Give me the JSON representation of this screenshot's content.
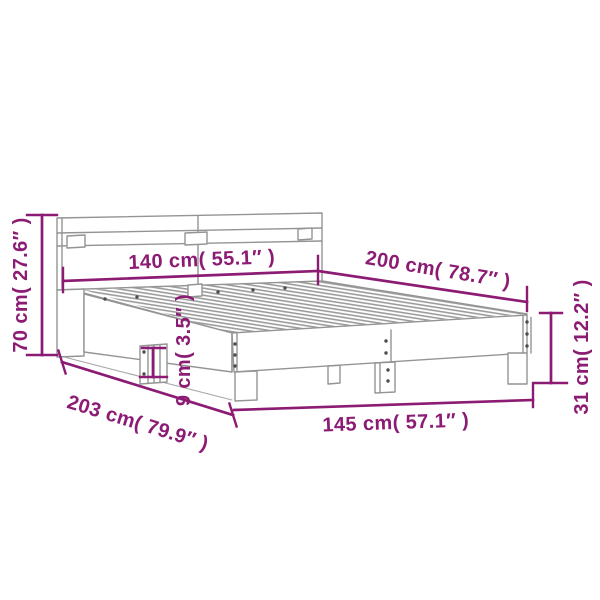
{
  "colors": {
    "accent": "#8c1b74",
    "line": "#949494",
    "line-light": "#9c9c9c",
    "dot": "#4d4d4d",
    "bg": "#ffffff"
  },
  "illustration": {
    "subject": "bed frame with headboard, slatted base and legs"
  },
  "dimension_labels": {
    "headboard_width": "140 cm( 55.1″ )",
    "bed_length": "200 cm( 78.7″ )",
    "headboard_height": "70 cm( 27.6″ )",
    "total_length": "203 cm( 79.9″ )",
    "total_width": "145 cm( 57.1″ )",
    "foot_end_height": "31 cm( 12.2″ )",
    "side_rail_height": "9 cm( 3.5″ )"
  }
}
